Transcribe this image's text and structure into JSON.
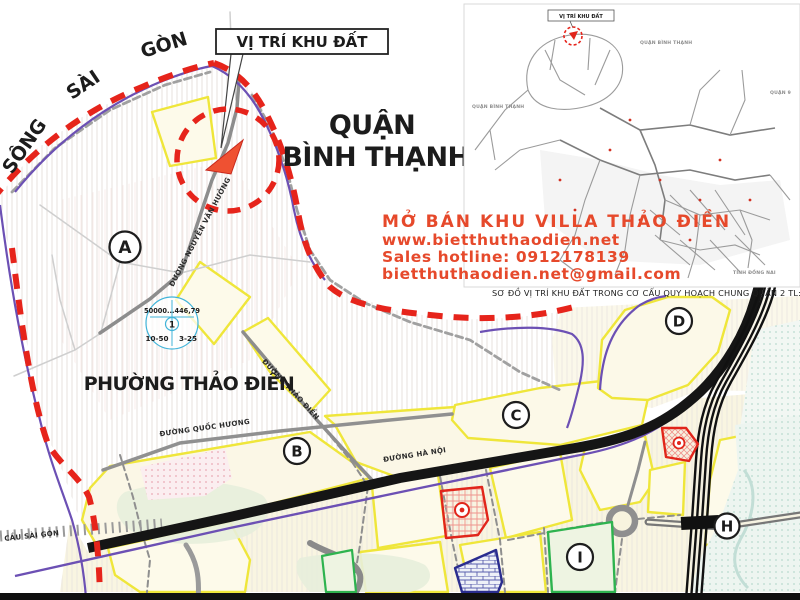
{
  "colors": {
    "boundary_red": "#e6241b",
    "river_purple": "#6c50b4",
    "parcel_yellow": "#efe63a",
    "highway_black": "#151515",
    "ad_text_red": "#e6492b",
    "stamp_cyan": "#41b4d9",
    "site_marker_red": "#ef5132"
  },
  "callout": {
    "site_label": "VỊ TRÍ KHU ĐẤT"
  },
  "district": {
    "line1": "QUẬN",
    "line2": "BÌNH THẠNH"
  },
  "ward": {
    "label": "PHƯỜNG THẢO ĐIỀN"
  },
  "river": {
    "word1": "SÔNG",
    "word2": "SÀI",
    "word3": "GÒN"
  },
  "ad": {
    "headline": "MỞ BÁN KHU VILLA THẢO ĐIỀN",
    "website": "www.bietthuthaodien.net",
    "hotline": "Sales hotline: 0912178139",
    "email": "bietthuthaodien.net@gmail.com"
  },
  "inset": {
    "site_label": "VỊ TRÍ KHU ĐẤT",
    "label_binh_thanh_top": "QUẬN BÌNH THẠNH",
    "label_binh_thanh_left": "QUẬN BÌNH THẠNH",
    "label_quan9": "QUẬN 9",
    "label_dong_nai": "TỈNH ĐỒNG NAI",
    "caption": "SƠ ĐỒ VỊ TRÍ KHU ĐẤT TRONG CƠ CẤU QUY HOẠCH CHUNG QUẬN 2   TL:1/25.000"
  },
  "zones": [
    {
      "label": "A"
    },
    {
      "label": "B"
    },
    {
      "label": "C"
    },
    {
      "label": "D"
    },
    {
      "label": "H"
    },
    {
      "label": "I"
    }
  ],
  "streets": [
    {
      "name": "ĐƯỜNG NGUYỄN VĂN HƯỞNG"
    },
    {
      "name": "ĐƯỜNG THẢO ĐIỀN"
    },
    {
      "name": "ĐƯỜNG QUỐC HƯƠNG"
    },
    {
      "name": "ĐƯỜNG HÀ NỘI"
    },
    {
      "name": "CẦU SÀI GÒN"
    }
  ],
  "stamp": {
    "row_top": "50000...446,79",
    "center": "1",
    "bottom_left": "10-50",
    "bottom_right": "3-25"
  }
}
